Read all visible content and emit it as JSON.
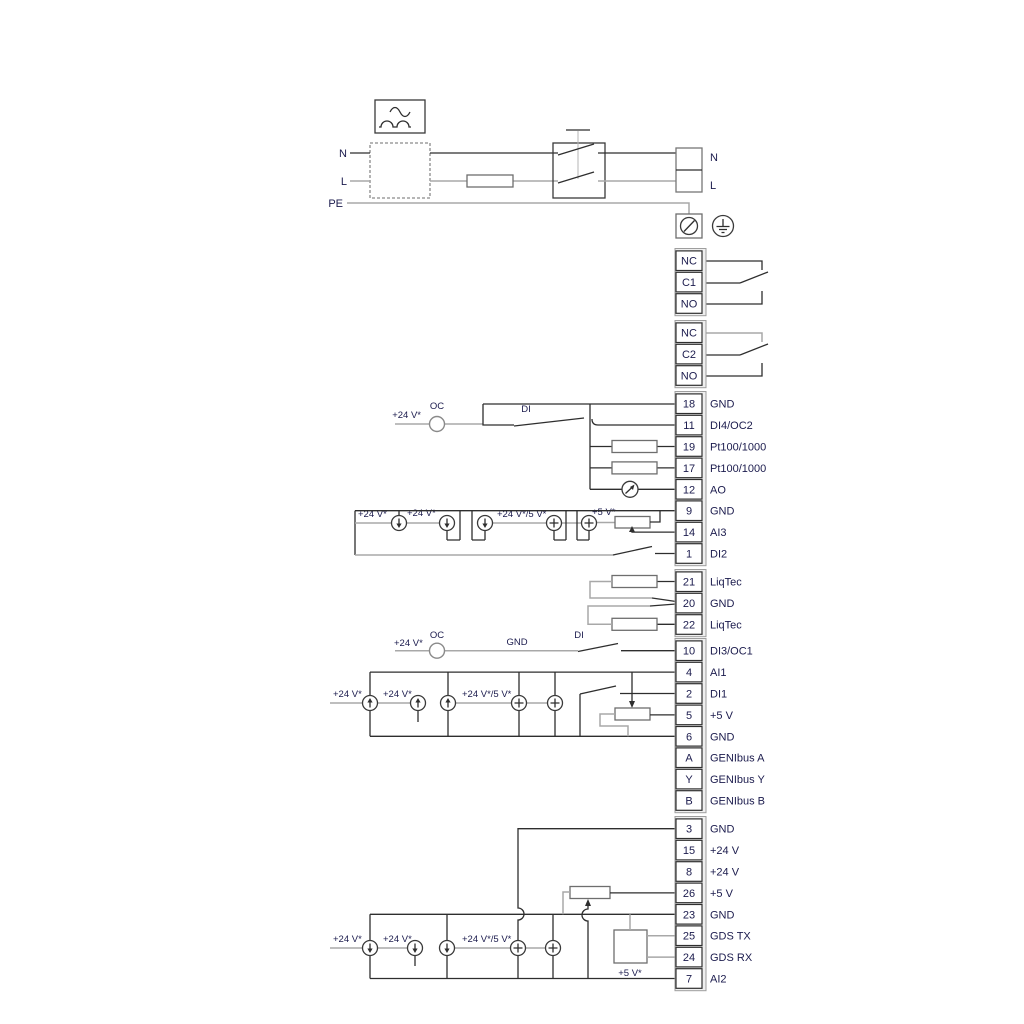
{
  "meta": {
    "type": "pump-wiring-diagram"
  },
  "colors": {
    "wire_dark": "#2e2e2e",
    "wire_gray": "#a8a8a8",
    "text": "#1b1b4d",
    "background": "#ffffff"
  },
  "power": {
    "n": "N",
    "l": "L",
    "pe": "PE"
  },
  "annotations": {
    "v24": "+24 V*",
    "v24_5": "+24 V*/5 V*",
    "v5": "+5 V*",
    "oc": "OC",
    "di": "DI",
    "gnd": "GND"
  },
  "terminal_strip": {
    "relay1": [
      {
        "n": "NC"
      },
      {
        "n": "C1"
      },
      {
        "n": "NO"
      }
    ],
    "relay2": [
      {
        "n": "NC"
      },
      {
        "n": "C2"
      },
      {
        "n": "NO"
      }
    ],
    "io1": [
      {
        "n": "18",
        "label": "GND"
      },
      {
        "n": "11",
        "label": "DI4/OC2"
      },
      {
        "n": "19",
        "label": "Pt100/1000"
      },
      {
        "n": "17",
        "label": "Pt100/1000"
      },
      {
        "n": "12",
        "label": "AO"
      },
      {
        "n": "9",
        "label": "GND"
      },
      {
        "n": "14",
        "label": "AI3"
      },
      {
        "n": "1",
        "label": "DI2"
      }
    ],
    "liqtec": [
      {
        "n": "21",
        "label": "LiqTec"
      },
      {
        "n": "20",
        "label": "GND"
      },
      {
        "n": "22",
        "label": "LiqTec"
      }
    ],
    "io2": [
      {
        "n": "10",
        "label": "DI3/OC1"
      },
      {
        "n": "4",
        "label": "AI1"
      },
      {
        "n": "2",
        "label": "DI1"
      },
      {
        "n": "5",
        "label": "+5 V"
      },
      {
        "n": "6",
        "label": "GND"
      },
      {
        "n": "A",
        "label": "GENIbus A"
      },
      {
        "n": "Y",
        "label": "GENIbus Y"
      },
      {
        "n": "B",
        "label": "GENIbus B"
      }
    ],
    "io3": [
      {
        "n": "3",
        "label": "GND"
      },
      {
        "n": "15",
        "label": "+24 V"
      },
      {
        "n": "8",
        "label": "+24 V"
      },
      {
        "n": "26",
        "label": "+5 V"
      },
      {
        "n": "23",
        "label": "GND"
      },
      {
        "n": "25",
        "label": "GDS TX"
      },
      {
        "n": "24",
        "label": "GDS RX"
      },
      {
        "n": "7",
        "label": "AI2"
      }
    ]
  }
}
